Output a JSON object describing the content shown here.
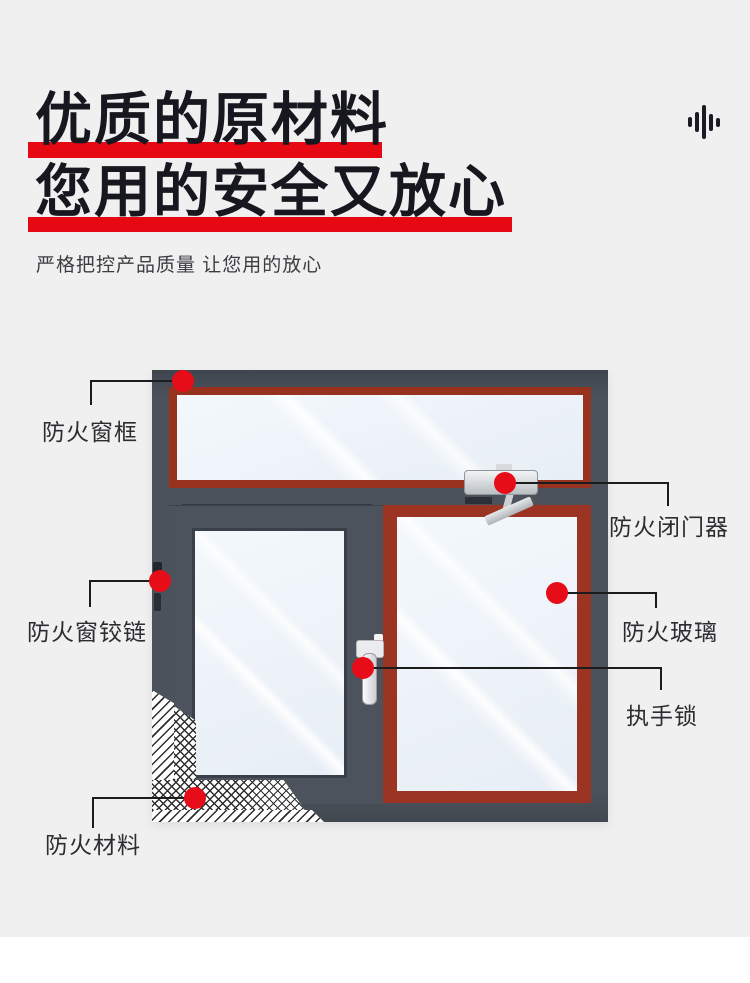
{
  "header": {
    "title_line1": "优质的原材料",
    "title_line2": "您用的安全又放心",
    "subtitle": "严格把控产品质量 让您用的放心",
    "accent_color": "#e60914",
    "audio_icon": "voice-waveform-icon"
  },
  "diagram": {
    "subject": "钢质防火窗产品标注图",
    "labels": [
      {
        "id": "frame",
        "text": "防火窗框"
      },
      {
        "id": "door_closer",
        "text": "防火闭门器"
      },
      {
        "id": "hinge",
        "text": "防火窗铰链"
      },
      {
        "id": "glass",
        "text": "防火玻璃"
      },
      {
        "id": "handle_lock",
        "text": "执手锁"
      },
      {
        "id": "material",
        "text": "防火材料"
      }
    ],
    "colors": {
      "frame": "#4b525c",
      "seal": "#9c3424",
      "glass": "#edf3f9",
      "callout_dot": "#e60c18",
      "callout_line": "#1c1c1c",
      "page_background": "#f1f0f0"
    }
  }
}
